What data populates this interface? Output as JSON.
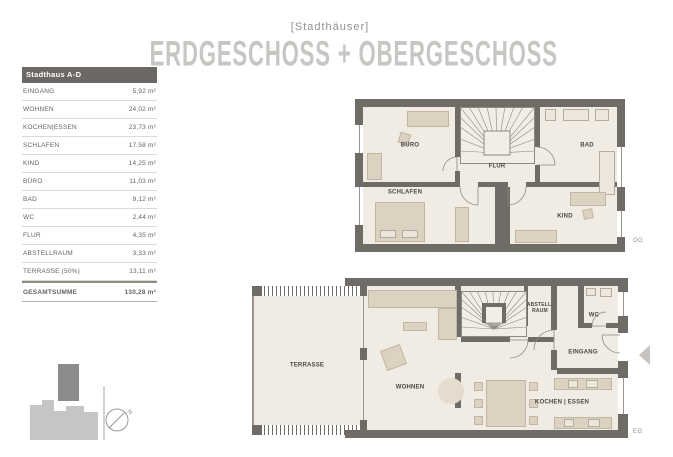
{
  "header": {
    "series_label": "[Stadthäuser]",
    "main_title": "ERDGESCHOSS + OBERGESCHOSS"
  },
  "area_table": {
    "title": "Stadthaus A-D",
    "rows": [
      {
        "label": "EINGANG",
        "value": "5,92 m²"
      },
      {
        "label": "WOHNEN",
        "value": "24,02 m²"
      },
      {
        "label": "KOCHEN|ESSEN",
        "value": "23,73 m²"
      },
      {
        "label": "SCHLAFEN",
        "value": "17,58 m²"
      },
      {
        "label": "KIND",
        "value": "14,25 m²"
      },
      {
        "label": "BÜRO",
        "value": "11,03 m²"
      },
      {
        "label": "BAD",
        "value": "9,12 m²"
      },
      {
        "label": "WC",
        "value": "2,44 m²"
      },
      {
        "label": "FLUR",
        "value": "4,35 m²"
      },
      {
        "label": "ABSTELLRAUM",
        "value": "3,33 m²"
      },
      {
        "label": "TERRASSE (50%)",
        "value": "13,11 m²"
      }
    ],
    "total": {
      "label": "GESAMTSUMME",
      "value": "130,28 m²"
    }
  },
  "floor_og": {
    "floor_tag": "OG",
    "rooms": {
      "buero": "BÜRO",
      "flur": "FLUR",
      "bad": "BAD",
      "schlafen": "SCHLAFEN",
      "kind": "KIND"
    }
  },
  "floor_eg": {
    "floor_tag": "EG",
    "rooms": {
      "terrasse": "TERRASSE",
      "wohnen": "WOHNEN",
      "abstellraum": "ABSTELL-\nRAUM",
      "wc": "WC",
      "eingang": "EINGANG",
      "kochen_essen": "KOCHEN | ESSEN"
    }
  },
  "site_plan": {
    "north_label": "N"
  },
  "colors": {
    "wall": "#6f6c68",
    "floor": "#f0ebe3",
    "furniture": "#dcd2c2",
    "title_gray": "#c8c6c3",
    "header_bar": "#6b6866"
  }
}
